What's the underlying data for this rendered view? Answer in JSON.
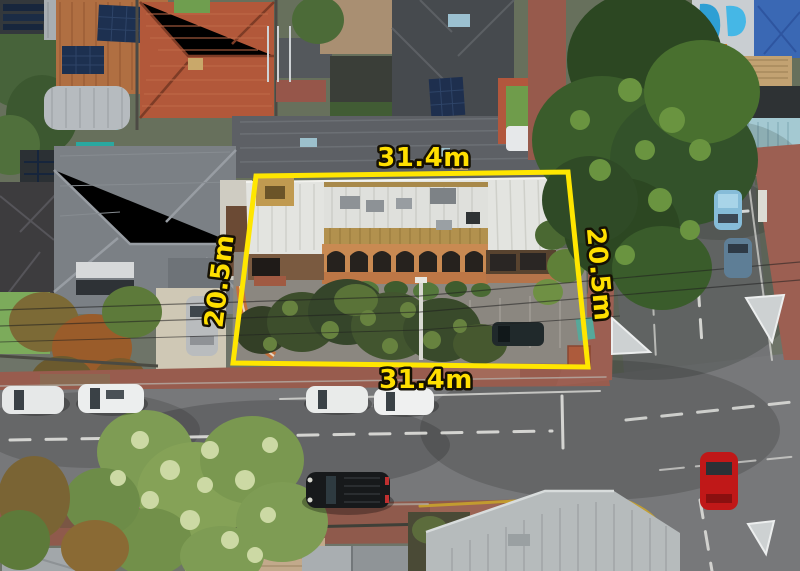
{
  "photo": {
    "type": "drone-aerial-property-photo",
    "subject": "Corner commercial property with brick arched facade, outlined in yellow with lot dimensions",
    "setting": "suburban street intersection with parked cars, rooftops and large trees"
  },
  "annotation": {
    "outline_color": "#ffe600",
    "label_fill": "#ffdf00",
    "label_stroke": "#151003",
    "dimensions": {
      "top": "31.4m",
      "bottom": "31.4m",
      "left": "20.5m",
      "right": "20.5m"
    }
  }
}
